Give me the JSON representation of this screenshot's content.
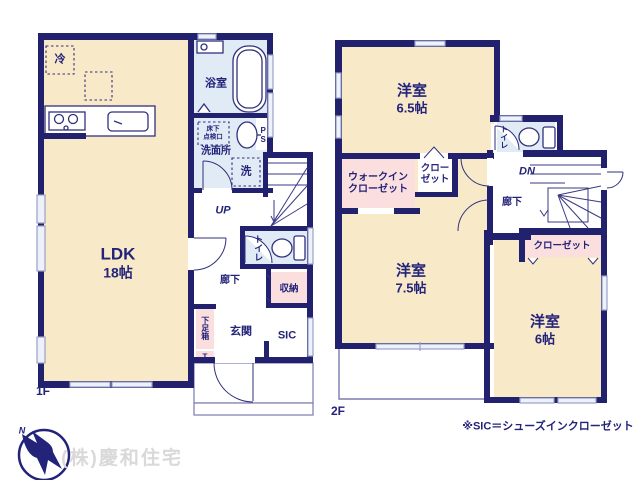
{
  "floors": {
    "f1": {
      "label": "1F",
      "rooms": {
        "ldk_name": "LDK",
        "ldk_size": "18帖",
        "fridge": "冷",
        "bath": "浴室",
        "underfloor1": "床下",
        "underfloor2": "点検口",
        "washroom": "洗面所",
        "washer": "洗",
        "ps": "PS",
        "ds": "DS",
        "up": "UP",
        "toilet": "トイレ",
        "hallway": "廊下",
        "storage": "収納",
        "shoebox": "下足箱",
        "shoebox_t": "T",
        "entrance": "玄関",
        "sic": "SIC"
      }
    },
    "f2": {
      "label": "2F",
      "rooms": {
        "bedroom1_name": "洋室",
        "bedroom1_size": "6.5帖",
        "bedroom2_name": "洋室",
        "bedroom2_size": "7.5帖",
        "bedroom3_name": "洋室",
        "bedroom3_size": "6帖",
        "wic_line1": "ウォークイン",
        "wic_line2": "クローゼット",
        "closet_line1": "クロー",
        "closet_line2": "ゼット",
        "closet_strip": "クローゼット",
        "toilet": "トイレ",
        "dn": "DN",
        "hallway": "廊下"
      }
    }
  },
  "footer": {
    "note": "※SIC＝シューズインクローゼット",
    "watermark": "(株)慶和住宅",
    "compass_label": "N"
  },
  "colors": {
    "wall_navy": "#21216e",
    "room_cream": "#f8e9c9",
    "closet_pink": "#fbdede",
    "wet_blue": "#e0ebf6",
    "watermark_gray": "#d9d9d9"
  }
}
